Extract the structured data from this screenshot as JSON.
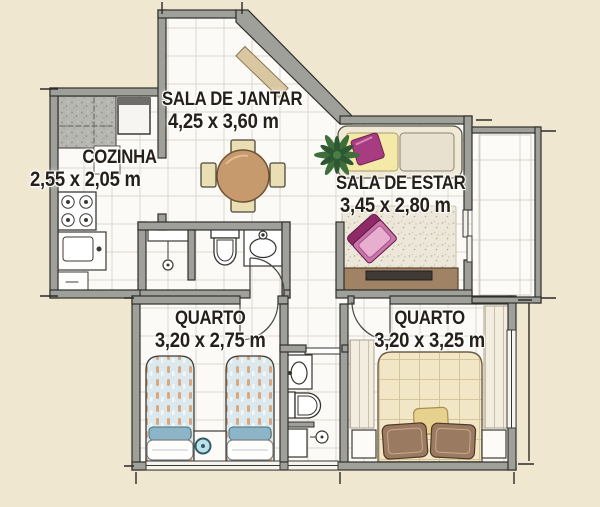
{
  "plan_type": "apartment-floor-plan",
  "rooms": [
    {
      "id": "dining",
      "label": "SALA DE JANTAR",
      "dims": "4,25 x 3,60 m"
    },
    {
      "id": "kitchen",
      "label": "COZINHA",
      "dims": "2,55 x 2,05 m"
    },
    {
      "id": "living",
      "label": "SALA DE ESTAR",
      "dims": "3,45 x 2,80 m"
    },
    {
      "id": "bedroom-1",
      "label": "QUARTO",
      "dims": "3,20 x 2,75 m"
    },
    {
      "id": "bedroom-2",
      "label": "QUARTO",
      "dims": "3,20 x 3,25 m"
    }
  ],
  "palette": {
    "background": "#f0e7d1",
    "wall_fill": "#a0a09b",
    "wall_outline": "#2e2e2b",
    "floor_tile": "#fbfaf7",
    "accent_magenta": "#a83c80",
    "table_wood": "#c79a6d",
    "rack_wood": "#a08264",
    "bed_blue": "#dbe8ee",
    "quilt_cream": "#f1e7c7",
    "label_text": "#26201a"
  }
}
